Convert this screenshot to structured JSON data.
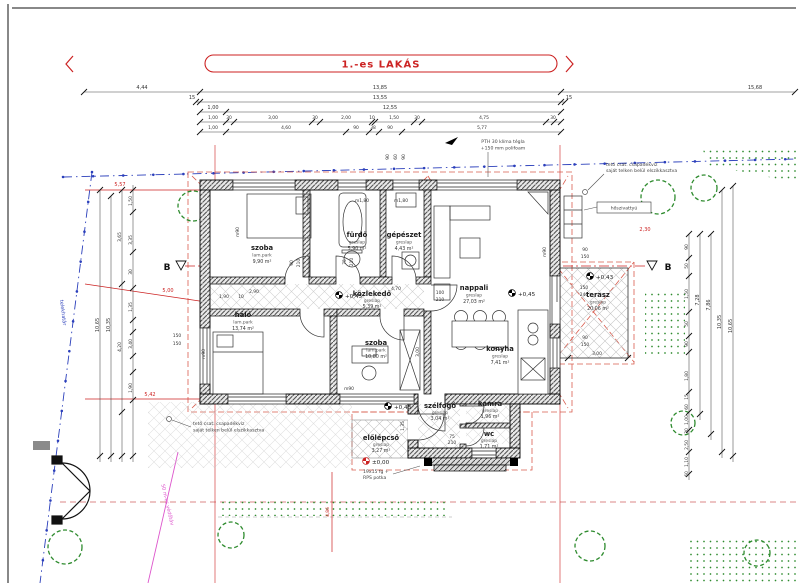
{
  "title": "1.-es LAKÁS",
  "section": {
    "left": "B",
    "right": "B"
  },
  "rooms": {
    "szoba1": {
      "name": "szoba",
      "floor": "lam.park",
      "area": "9,90 m²"
    },
    "furdo": {
      "name": "fürdő",
      "floor": "greslap",
      "area": "5,90 m²"
    },
    "gepeszet": {
      "name": "gépészet",
      "floor": "greslap",
      "area": "4,43 m²"
    },
    "kozlekedo": {
      "name": "közlekedő",
      "floor": "greslap",
      "area": "5,39 m²"
    },
    "nappali": {
      "name": "nappali",
      "floor": "greslap",
      "area": "27,03 m²"
    },
    "halo": {
      "name": "háló",
      "floor": "lam.park",
      "area": "13,74 m²"
    },
    "szoba2": {
      "name": "szoba",
      "floor": "lam.park",
      "area": "10,80 m²"
    },
    "konyha": {
      "name": "konyha",
      "floor": "greslap",
      "area": "7,41 m²"
    },
    "terasz": {
      "name": "terasz",
      "floor": "greslap",
      "area": "20,06 m²"
    },
    "szelfogo": {
      "name": "szélfogó",
      "floor": "greslap",
      "area": "3,04 m²"
    },
    "kamra": {
      "name": "kamra",
      "floor": "greslap",
      "area": "1,96 m²"
    },
    "wc": {
      "name": "wc",
      "floor": "greslap",
      "area": "1,71 m²"
    },
    "elolepcso": {
      "name": "előlépcső",
      "floor": "greslap",
      "area": "3,27 m²"
    }
  },
  "levels": {
    "kozlekedo": "+0,45",
    "nappali": "+0,45",
    "terasz": "+0,43",
    "porch": "+0,43",
    "entrance": "±0,00"
  },
  "window_heights": {
    "furdo": "m1,80",
    "gepeszet": "m1,80",
    "szoba_n": "m90",
    "halo_w": "m90",
    "szoba2_s": "m90",
    "nappali_e": "m90"
  },
  "notes": {
    "wall1": "PTH 30 klíma tégla",
    "wall2": "+150 mm polifoam",
    "rain1": "tető csat. csapadékvíz",
    "rain2": "saját telken belül elszikkasztva",
    "steps1": "19x15 fg +",
    "steps2": "RPS potka",
    "heat_pump": "hőszivattyú",
    "boundary": "telekhatár",
    "protection": "50 m-es védőtáv"
  },
  "dims": {
    "far": [
      "4,44",
      "15,68"
    ],
    "row1": [
      "13,85"
    ],
    "row2": [
      "15",
      "13,55",
      "15"
    ],
    "row3": [
      "1,00",
      "12,55"
    ],
    "row4": [
      "1,00",
      "30",
      "3,00",
      "30",
      "2,00",
      "10",
      "1,50",
      "30",
      "4,75",
      "30"
    ],
    "row5": [
      "1,00",
      "4,60",
      "90",
      "38",
      "90",
      "5,77"
    ],
    "topwall": [
      "90",
      "60",
      "90"
    ],
    "left": [
      "5,57",
      "5,00",
      "5,42",
      "10,65",
      "10,35",
      "3,65",
      "3,35",
      "1,50",
      "30",
      "4,20",
      "3,40",
      "1,90",
      "1,35",
      "150",
      "150",
      "4,86"
    ],
    "right": [
      "2,30",
      "90",
      "50",
      "1,50",
      "50",
      "90",
      "1,80",
      "15",
      "60",
      "1,00",
      "30",
      "2,50",
      "1,10",
      "60",
      "7,28",
      "7,86",
      "10,35",
      "10,65"
    ],
    "terasz": [
      "90",
      "150",
      "150",
      "240",
      "90",
      "150",
      "3,00"
    ],
    "inner": [
      "2,90",
      "4,70",
      "1,90",
      "10",
      "90",
      "210",
      "75",
      "210",
      "75",
      "210",
      "100",
      "210",
      "1,35",
      "3,00"
    ]
  },
  "colors": {
    "red": "#cc2222",
    "blue": "#2b3fbb",
    "green": "#2e8b2e",
    "pink": "#dd55cc",
    "wall": "#1a1a1a"
  }
}
